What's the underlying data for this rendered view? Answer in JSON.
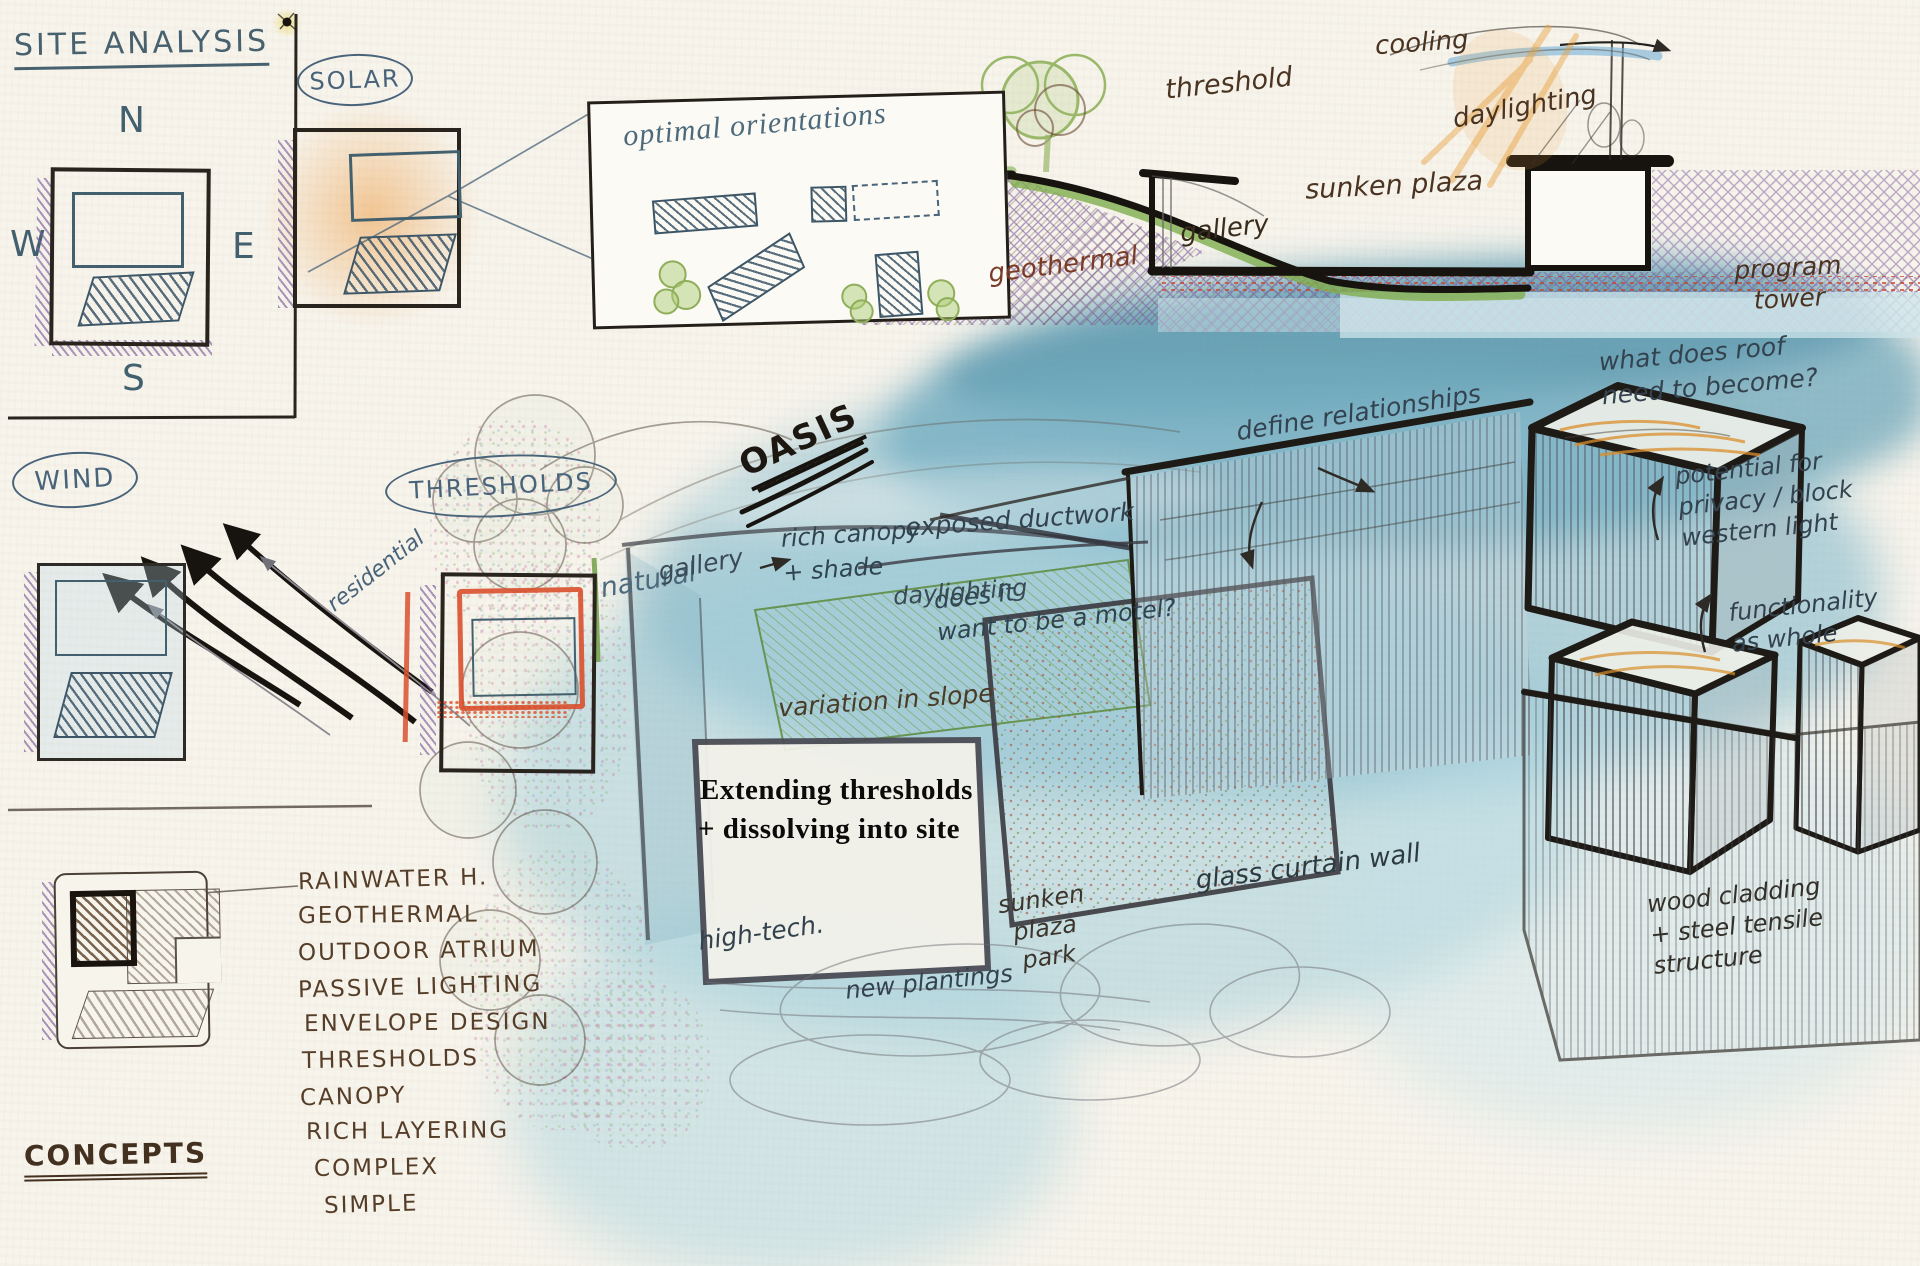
{
  "page": {
    "caption_line1": "Extending thresholds",
    "caption_line2": "+ dissolving into site"
  },
  "site_analysis": {
    "title": "SITE ANALYSIS",
    "compass": {
      "n": "N",
      "e": "E",
      "s": "S",
      "w": "W"
    }
  },
  "solar": {
    "label": "SOLAR",
    "panel_title": "optimal orientations"
  },
  "wind": {
    "label": "WIND"
  },
  "thresholds": {
    "label": "THRESHOLDS",
    "residential": "residential",
    "natural": "natural"
  },
  "oasis": {
    "title": "OASIS"
  },
  "section": {
    "threshold": "threshold",
    "cooling": "cooling",
    "daylighting": "daylighting",
    "sunken_plaza": "sunken plaza",
    "gallery": "gallery",
    "geothermal": "geothermal",
    "program_tower": "program\ntower"
  },
  "perspective": {
    "rich_canopy": "rich canopy\n+ shade",
    "model_question": "does it\nwant to be a motel?",
    "define_relationships": "define relationships",
    "roof_question": "what does roof\nneed to become?",
    "privacy_note": "potential for\nprivacy / block\nwestern light",
    "functionality_note": "functionality\nas whole",
    "exposed_ductwork": "exposed ductwork",
    "gallery": "gallery",
    "daylighting": "daylighting",
    "variation_slope": "variation in slope",
    "sunken_plaza_park": "sunken\nplaza\npark",
    "glass_curtain": "glass curtain wall",
    "wood_cladding": "wood cladding\n+ steel tensile\nstructure",
    "high_tech": "high-tech.",
    "new_plantings": "new plantings"
  },
  "concepts": {
    "title": "CONCEPTS",
    "items": [
      "RAINWATER H.",
      "GEOTHERMAL",
      "OUTDOOR ATRIUM",
      "PASSIVE LIGHTING",
      "ENVELOPE DESIGN",
      "THRESHOLDS",
      "CANOPY",
      "RICH LAYERING",
      "COMPLEX",
      "SIMPLE"
    ]
  },
  "colors": {
    "paper": "#f7f4ec",
    "ink_blue": "#43606f",
    "ink_brown": "#4a3424",
    "marker_black": "#17130e",
    "wash_teal": "#74aec6",
    "crayon_orange": "#e8a13f",
    "crayon_purple": "#8a63ad",
    "accent_red": "#d9502e",
    "green": "#7fae4e"
  }
}
